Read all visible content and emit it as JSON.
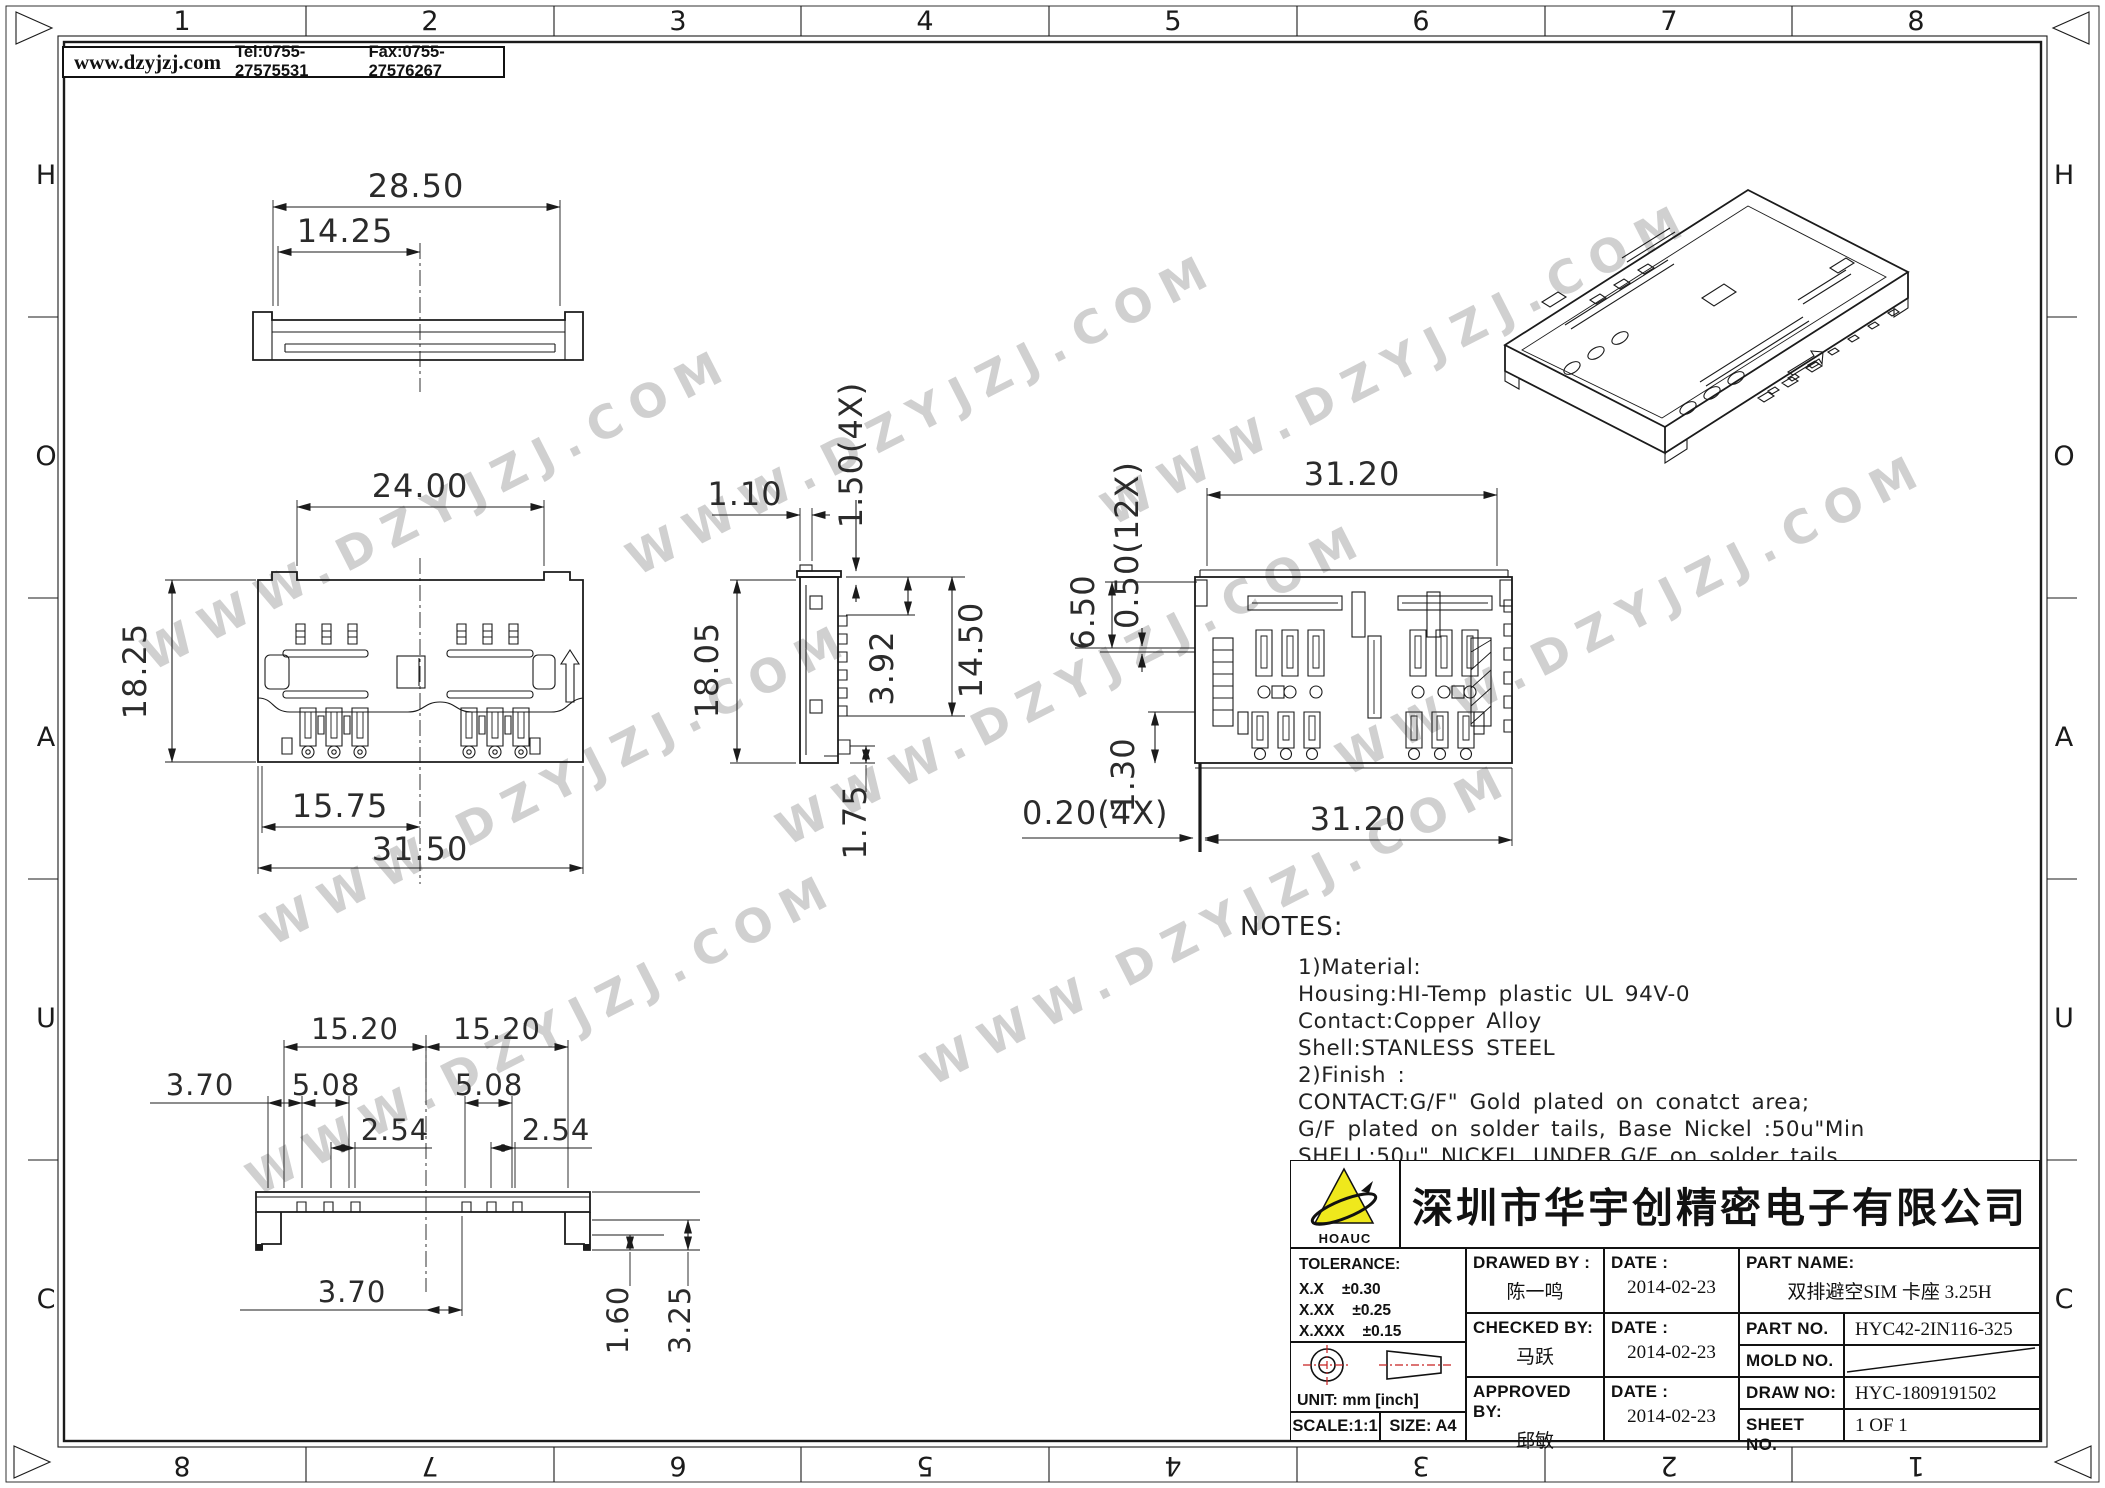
{
  "header": {
    "website": "www.dzyjzj.com",
    "tel": "Tel:0755-27575531",
    "fax": "Fax:0755-27576267"
  },
  "watermark": {
    "text": "WWW.DZYJZJ.COM",
    "color": "#a3a3a3"
  },
  "border": {
    "cols_top": [
      "1",
      "2",
      "3",
      "4",
      "5",
      "6",
      "7",
      "8"
    ],
    "cols_bottom": [
      "8",
      "7",
      "6",
      "5",
      "4",
      "3",
      "2",
      "1"
    ],
    "rows_left": [
      "H",
      "O",
      "A",
      "U",
      "C"
    ],
    "rows_right": [
      "H",
      "O",
      "A",
      "U",
      "C"
    ]
  },
  "views": {
    "top": {
      "w": "28.50",
      "half": "14.25"
    },
    "front": {
      "top": "24.00",
      "h": "18.25",
      "half": "15.75",
      "w": "31.50"
    },
    "side": {
      "tab": "1.10",
      "pitch": "1.50(4X)",
      "h": "18.05",
      "d1": "3.92",
      "d2": "14.50",
      "foot": "1.75"
    },
    "bottom": {
      "w_top": "31.20",
      "e1": "6.50",
      "pitch": "0.50(12X)",
      "step": "1.30",
      "gap": "0.20(4X)",
      "w_bot": "31.20"
    },
    "pins": {
      "l": "15.20",
      "r": "15.20",
      "a": "3.70",
      "p1": "5.08",
      "p2": "5.08",
      "s1": "2.54",
      "s2": "2.54",
      "c": "3.70",
      "h1": "1.60",
      "h2": "3.25"
    }
  },
  "notes": {
    "title": "NOTES:",
    "lines": [
      "1)Material:",
      "Housing:HI-Temp  plastic  UL  94V-0",
      "Contact:Copper  Alloy",
      "Shell:STANLESS  STEEL",
      "2)Finish  :",
      "CONTACT:G/F\"  Gold  plated  on  conatct  area;",
      "G/F  plated  on  solder  tails,  Base  Nickel  :50u\"Min",
      "SHELL:50u\"  NICKEL  UNDER,G/F  on  solder  tails"
    ]
  },
  "title_block": {
    "logo_text": "HOAUC",
    "logo_color": "#efe81c",
    "company": "深圳市华宇创精密电子有限公司",
    "tolerance": {
      "title": "TOLERANCE:",
      "rows": [
        [
          "X.X",
          "±0.30"
        ],
        [
          "X.XX",
          "±0.25"
        ],
        [
          "X.XXX",
          "±0.15"
        ]
      ],
      "deg1": "X.°  ±2°",
      "deg2": "X.X°  ±0.5°"
    },
    "unit_label": "UNIT:",
    "unit_value": "mm  [inch]",
    "scale": "SCALE:1:1",
    "size": "SIZE:  A4",
    "fields": {
      "drawed": {
        "label": "DRAWED  BY :",
        "value": "陈一鸣"
      },
      "date1": {
        "label": "DATE :",
        "value": "2014-02-23"
      },
      "part_name": {
        "label": "PART  NAME:",
        "value": "双排避空SIM 卡座 3.25H"
      },
      "checked": {
        "label": "CHECKED  BY:",
        "value": "马跃"
      },
      "date2": {
        "label": "DATE :",
        "value": "2014-02-23"
      },
      "part_no": {
        "label": "PART  NO.",
        "value": "HYC42-2IN116-325"
      },
      "mold_no": {
        "label": "MOLD  NO.",
        "value": ""
      },
      "approved": {
        "label": "APPROVED  BY:",
        "value": "邱敏"
      },
      "date3": {
        "label": "DATE :",
        "value": "2014-02-23"
      },
      "draw_no": {
        "label": "DRAW  NO:",
        "value": "HYC-1809191502"
      },
      "sheet_no": {
        "label": "SHEET  NO.",
        "value": "1  OF  1"
      }
    }
  }
}
